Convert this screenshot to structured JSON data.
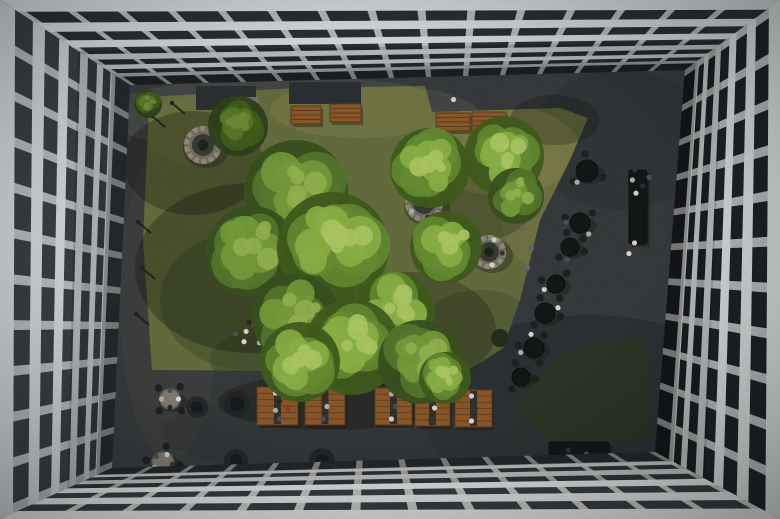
{
  "image": {
    "width": 780,
    "height": 519,
    "description": "Aerial top-down view of an office building courtyard with lawn, trees, stone fire pits, wooden benches, picnic tables, cafe tables and people"
  },
  "palette": {
    "asphalt": "#3b3e40",
    "lawn": "#6b7342",
    "lawn_dark": "#2f3827",
    "shadow": "#10150b",
    "wood": "#935d2c",
    "wood_dark": "#5f3d1d",
    "stone_fill": "#7a7366",
    "stone_ring": "#9b9383",
    "stone_inner": "#3a3f35",
    "stone_core": "#20251e",
    "table_dark": "#151819",
    "chair_dark": "#202426",
    "light_table": "#8a8376",
    "light_table_edge": "#6e685c",
    "planter": "#2f3335",
    "paver": "#7b786f",
    "bollard": "#23272a",
    "accent_red": "#a33d35",
    "person_colors": [
      "#e6e6e3",
      "#2b2e30",
      "#b9bcbd",
      "#51565a",
      "#dfe0de",
      "#35393c"
    ]
  },
  "scene": {
    "opening": [
      [
        130,
        85
      ],
      [
        685,
        70
      ],
      [
        655,
        452
      ],
      [
        112,
        468
      ]
    ],
    "facades": [
      {
        "name": "top",
        "outer": [
          [
            0,
            0
          ],
          [
            780,
            0
          ]
        ],
        "inner": [
          [
            130,
            85
          ],
          [
            685,
            70
          ]
        ],
        "beams": 6,
        "beam_ratio": 0.52,
        "mullions": 15,
        "mullion_w": 0.011,
        "q": 0.78,
        "white": "#e3e6e9",
        "glass": "#2b3135"
      },
      {
        "name": "left",
        "outer": [
          [
            0,
            519
          ],
          [
            0,
            0
          ]
        ],
        "inner": [
          [
            112,
            468
          ],
          [
            130,
            85
          ]
        ],
        "beams": 6,
        "beam_ratio": 0.46,
        "mullions": 11,
        "mullion_w": 0.02,
        "q": 0.8,
        "white": "#d9dde0",
        "glass": "#3a4146"
      },
      {
        "name": "right",
        "outer": [
          [
            780,
            0
          ],
          [
            780,
            519
          ]
        ],
        "inner": [
          [
            685,
            70
          ],
          [
            655,
            452
          ]
        ],
        "beams": 6,
        "beam_ratio": 0.46,
        "mullions": 11,
        "mullion_w": 0.02,
        "q": 0.8,
        "white": "#eaedee",
        "glass": "#1f2428"
      },
      {
        "name": "bottom",
        "outer": [
          [
            780,
            519
          ],
          [
            0,
            519
          ]
        ],
        "inner": [
          [
            655,
            452
          ],
          [
            112,
            468
          ]
        ],
        "beams": 5,
        "beam_ratio": 0.55,
        "mullions": 13,
        "mullion_w": 0.013,
        "q": 0.78,
        "white": "#f0f1f2",
        "glass": "#3a4045"
      }
    ],
    "floor_patches": [
      {
        "x": 290,
        "y": 115,
        "rx": 190,
        "ry": 38,
        "fill": "#565852",
        "o": 0.5
      },
      {
        "x": 170,
        "y": 300,
        "rx": 50,
        "ry": 160,
        "fill": "#4a4c49",
        "o": 0.4
      },
      {
        "x": 590,
        "y": 410,
        "rx": 170,
        "ry": 95,
        "fill": "#26292b",
        "o": 0.5
      },
      {
        "x": 360,
        "y": 432,
        "rx": 200,
        "ry": 42,
        "fill": "#333638",
        "o": 0.5
      },
      {
        "x": 620,
        "y": 140,
        "rx": 90,
        "ry": 70,
        "fill": "#303335",
        "o": 0.5
      }
    ],
    "lawn": {
      "main": [
        [
          150,
          97
        ],
        [
          295,
          88
        ],
        [
          425,
          86
        ],
        [
          432,
          112
        ],
        [
          560,
          108
        ],
        [
          588,
          118
        ],
        [
          570,
          160
        ],
        [
          540,
          220
        ],
        [
          520,
          300
        ],
        [
          503,
          348
        ],
        [
          466,
          372
        ],
        [
          152,
          370
        ],
        [
          143,
          240
        ],
        [
          148,
          130
        ]
      ],
      "dark_patch": [
        [
          564,
          352
        ],
        [
          645,
          337
        ],
        [
          650,
          440
        ],
        [
          548,
          438
        ],
        [
          518,
          414
        ],
        [
          532,
          384
        ]
      ],
      "blotches": [
        {
          "x": 500,
          "y": 150,
          "rx": 80,
          "ry": 45,
          "fill": "#8e8a54",
          "o": 0.55
        },
        {
          "x": 545,
          "y": 210,
          "rx": 45,
          "ry": 60,
          "fill": "#84814f",
          "o": 0.5
        },
        {
          "x": 360,
          "y": 110,
          "rx": 90,
          "ry": 28,
          "fill": "#8a8752",
          "o": 0.45
        },
        {
          "x": 200,
          "y": 130,
          "rx": 55,
          "ry": 35,
          "fill": "#7d7c4a",
          "o": 0.4
        },
        {
          "x": 250,
          "y": 300,
          "rx": 90,
          "ry": 70,
          "fill": "#45512e",
          "o": 0.5
        },
        {
          "x": 320,
          "y": 360,
          "rx": 110,
          "ry": 40,
          "fill": "#404b2b",
          "o": 0.5
        },
        {
          "x": 480,
          "y": 330,
          "rx": 60,
          "ry": 40,
          "fill": "#4a5530",
          "o": 0.45
        }
      ]
    },
    "planters": [
      {
        "x": 196,
        "y": 86,
        "w": 60,
        "h": 24
      },
      {
        "x": 289,
        "y": 82,
        "w": 72,
        "h": 22
      }
    ],
    "pavers": [
      {
        "x": 232,
        "y": 97,
        "w": 26,
        "h": 20
      }
    ],
    "tree_shadows": [
      {
        "x": 250,
        "y": 268,
        "rx": 115,
        "ry": 85,
        "o": 0.3
      },
      {
        "x": 193,
        "y": 163,
        "rx": 70,
        "ry": 52,
        "o": 0.3
      },
      {
        "x": 408,
        "y": 330,
        "rx": 88,
        "ry": 58,
        "o": 0.25
      },
      {
        "x": 330,
        "y": 402,
        "rx": 112,
        "ry": 28,
        "o": 0.3
      },
      {
        "x": 476,
        "y": 198,
        "rx": 60,
        "ry": 44,
        "o": 0.22
      },
      {
        "x": 555,
        "y": 120,
        "rx": 45,
        "ry": 25,
        "o": 0.25
      }
    ],
    "fire_pits": [
      {
        "x": 203,
        "y": 145,
        "r": 19,
        "people": 0
      },
      {
        "x": 424,
        "y": 203,
        "r": 19,
        "people": 5
      },
      {
        "x": 489,
        "y": 252,
        "r": 17,
        "people": 5
      },
      {
        "x": 370,
        "y": 297,
        "r": 17,
        "people": 3
      }
    ],
    "benches": [
      {
        "x": 291,
        "y": 106,
        "w": 30,
        "h": 18
      },
      {
        "x": 330,
        "y": 104,
        "w": 31,
        "h": 18
      },
      {
        "x": 436,
        "y": 113,
        "w": 34,
        "h": 18
      },
      {
        "x": 472,
        "y": 112,
        "w": 34,
        "h": 18
      }
    ],
    "picnic_tables": [
      {
        "x": 257,
        "y": 387,
        "w": 41,
        "h": 38,
        "people": 4
      },
      {
        "x": 305,
        "y": 388,
        "w": 40,
        "h": 37,
        "people": 3
      },
      {
        "x": 375,
        "y": 388,
        "w": 37,
        "h": 37,
        "people": 3
      },
      {
        "x": 415,
        "y": 390,
        "w": 35,
        "h": 36,
        "people": 3
      },
      {
        "x": 455,
        "y": 390,
        "w": 37,
        "h": 37,
        "people": 3
      }
    ],
    "round_tables": [
      {
        "x": 587,
        "y": 171,
        "r": 11,
        "people": 2
      },
      {
        "x": 580,
        "y": 223,
        "r": 10,
        "people": 2
      },
      {
        "x": 570,
        "y": 247,
        "r": 9,
        "people": 1
      },
      {
        "x": 556,
        "y": 284,
        "r": 9,
        "people": 2
      },
      {
        "x": 545,
        "y": 313,
        "r": 10,
        "people": 2
      },
      {
        "x": 534,
        "y": 348,
        "r": 10,
        "people": 3
      },
      {
        "x": 521,
        "y": 377,
        "r": 9,
        "people": 1
      }
    ],
    "light_tables": [
      {
        "x": 170,
        "y": 399,
        "r": 10,
        "people": 4
      },
      {
        "x": 163,
        "y": 463,
        "r": 11,
        "people": 5
      }
    ],
    "aux_blobs": [
      {
        "x": 197,
        "y": 407,
        "r": 11
      },
      {
        "x": 237,
        "y": 404,
        "r": 13
      },
      {
        "x": 236,
        "y": 461,
        "r": 12
      },
      {
        "x": 322,
        "y": 461,
        "r": 13
      }
    ],
    "long_tables": [
      {
        "x": 629,
        "y": 170,
        "w": 18,
        "h": 74
      },
      {
        "x": 549,
        "y": 442,
        "w": 60,
        "h": 26
      }
    ],
    "people_groups": [
      {
        "x": 640,
        "y": 182,
        "n": 5,
        "spread": 14
      },
      {
        "x": 638,
        "y": 247,
        "n": 3,
        "spread": 12
      },
      {
        "x": 578,
        "y": 462,
        "n": 5,
        "spread": 16
      },
      {
        "x": 250,
        "y": 334,
        "n": 8,
        "spread": 17
      },
      {
        "x": 412,
        "y": 366,
        "n": 2,
        "spread": 6
      },
      {
        "x": 455,
        "y": 100,
        "n": 1,
        "spread": 2
      }
    ],
    "red_dots": [
      [
        254,
        325
      ],
      [
        601,
        469
      ],
      [
        288,
        409
      ]
    ],
    "bollards": [
      {
        "x": 138,
        "y": 222
      },
      {
        "x": 142,
        "y": 268
      },
      {
        "x": 136,
        "y": 314
      },
      {
        "x": 152,
        "y": 116
      },
      {
        "x": 172,
        "y": 103
      }
    ],
    "stones": [
      [
        523,
        228
      ],
      [
        531,
        248
      ],
      [
        527,
        268
      ]
    ],
    "bushes": [
      {
        "x": 500,
        "y": 338,
        "r": 9
      }
    ],
    "trees": [
      {
        "x": 148,
        "y": 104,
        "r": 14,
        "tone": "dark"
      },
      {
        "x": 238,
        "y": 126,
        "r": 30,
        "tone": "dark"
      },
      {
        "x": 296,
        "y": 192,
        "r": 52,
        "tone": "mid"
      },
      {
        "x": 252,
        "y": 252,
        "r": 46,
        "tone": "mid"
      },
      {
        "x": 333,
        "y": 248,
        "r": 56,
        "tone": "bright"
      },
      {
        "x": 395,
        "y": 312,
        "r": 40,
        "tone": "bright"
      },
      {
        "x": 296,
        "y": 318,
        "r": 44,
        "tone": "mid"
      },
      {
        "x": 430,
        "y": 168,
        "r": 40,
        "tone": "bright"
      },
      {
        "x": 504,
        "y": 156,
        "r": 40,
        "tone": "bright"
      },
      {
        "x": 516,
        "y": 196,
        "r": 28,
        "tone": "mid"
      },
      {
        "x": 446,
        "y": 247,
        "r": 36,
        "tone": "bright"
      },
      {
        "x": 352,
        "y": 347,
        "r": 48,
        "tone": "bright"
      },
      {
        "x": 420,
        "y": 362,
        "r": 42,
        "tone": "mid"
      },
      {
        "x": 300,
        "y": 362,
        "r": 40,
        "tone": "bright"
      },
      {
        "x": 445,
        "y": 378,
        "r": 26,
        "tone": "bright"
      }
    ]
  }
}
